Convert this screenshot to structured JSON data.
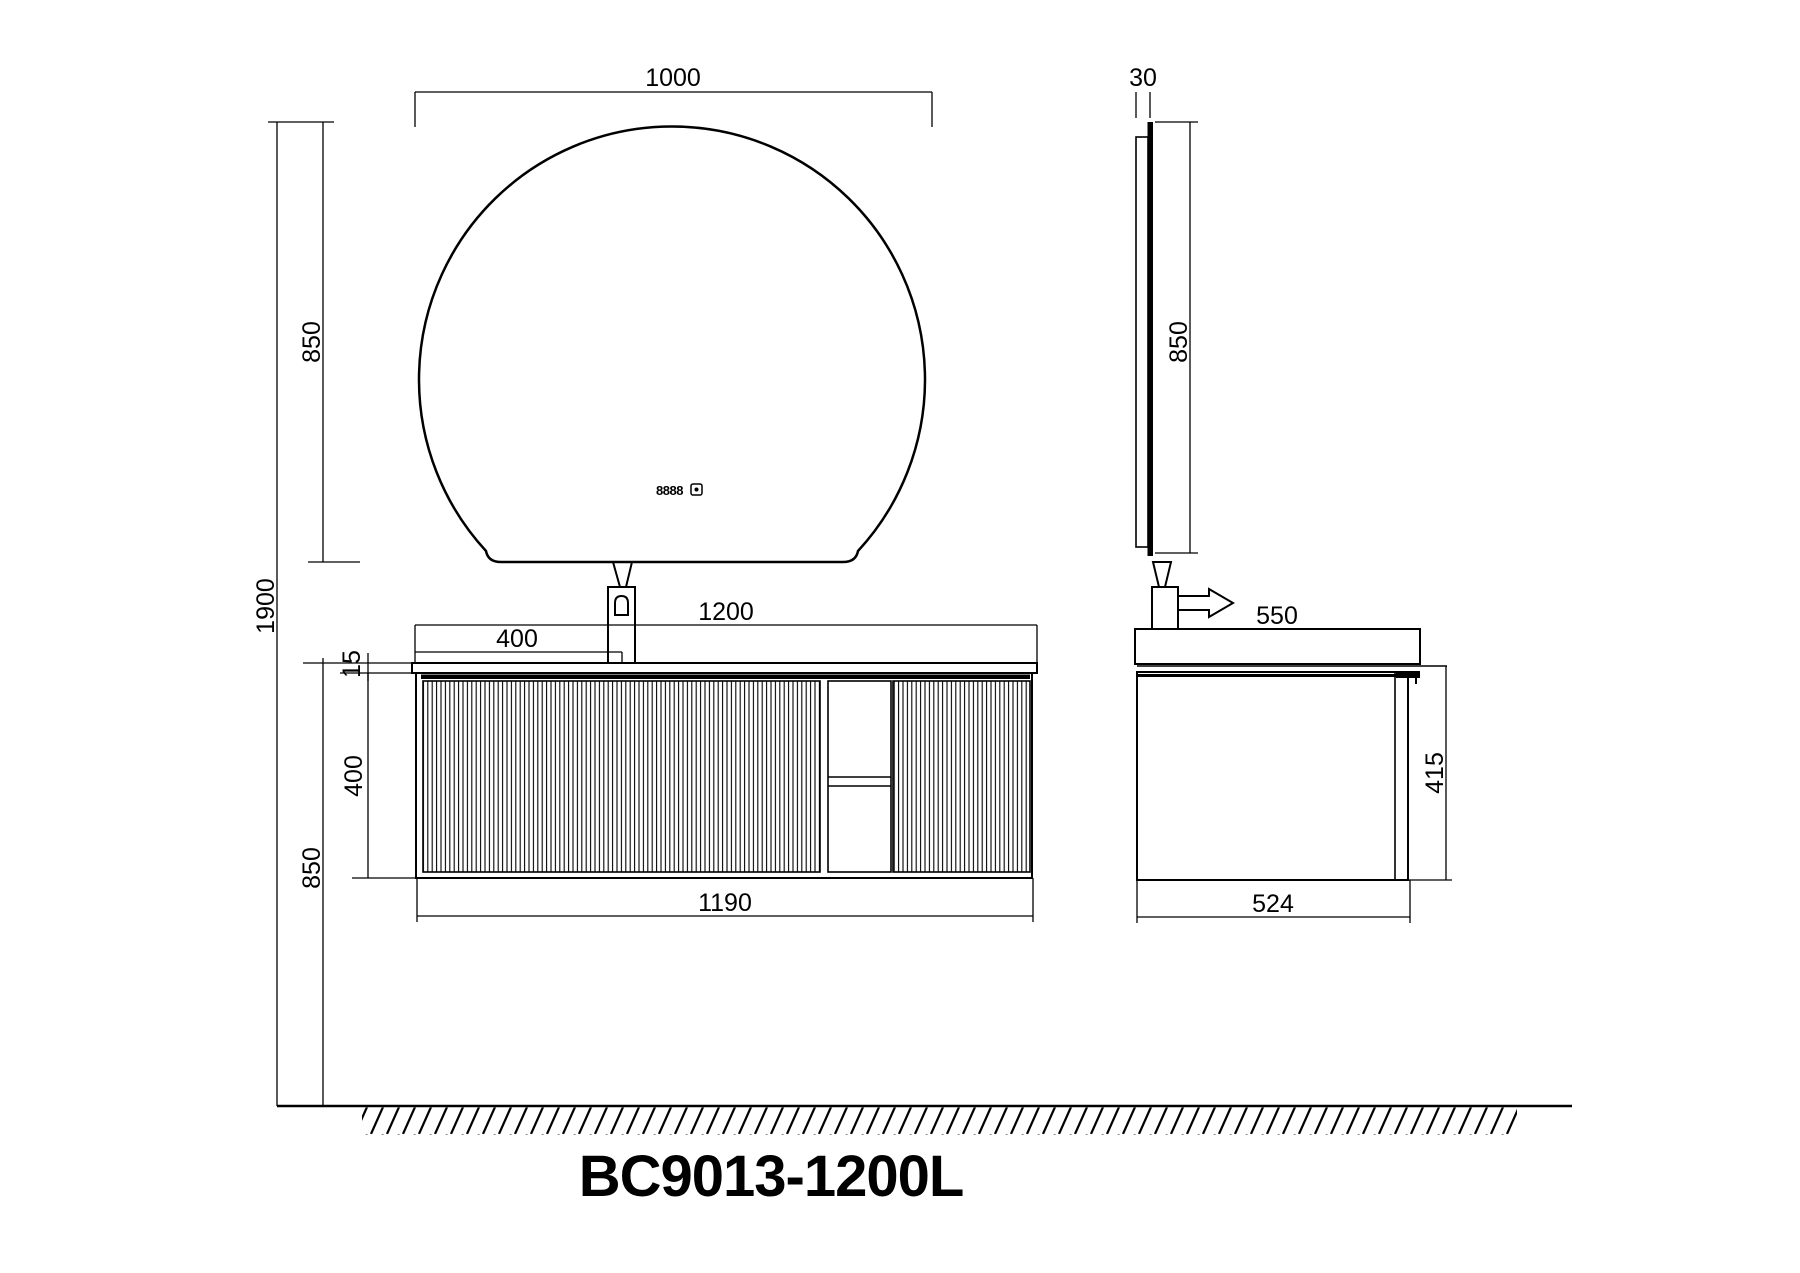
{
  "drawing": {
    "model_label": "BC9013-1200L",
    "mirror_display_value": "8888",
    "front": {
      "dim_mirror_width": "1000",
      "dim_mirror_height": "850",
      "dim_total_height": "1900",
      "dim_floor_to_counter": "850",
      "dim_counter_thickness": "15",
      "dim_cabinet_height": "400",
      "dim_counter_width": "1200",
      "dim_faucet_offset": "400",
      "dim_cabinet_width": "1190"
    },
    "side": {
      "dim_mirror_thickness": "30",
      "dim_mirror_height": "850",
      "dim_counter_depth": "550",
      "dim_cabinet_height": "415",
      "dim_cabinet_depth": "524"
    },
    "colors": {
      "line_color": "#000000",
      "background_color": "#ffffff"
    }
  }
}
